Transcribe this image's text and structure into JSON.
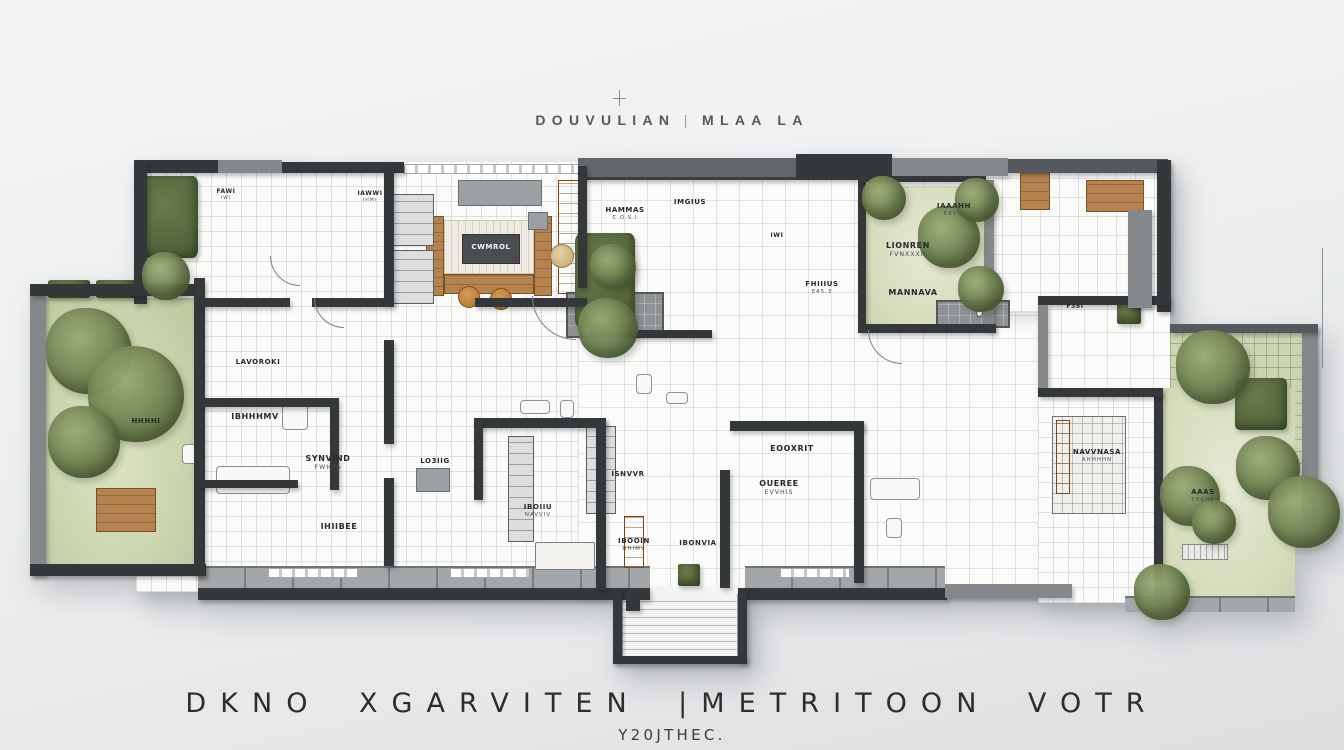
{
  "title": {
    "left": "DOUVULIAN",
    "separator": "|",
    "right": "MLAA LA"
  },
  "caption": {
    "line1": "DKNO XGARVITEN |METRITOON VOTR",
    "line2": "Y20JTHEC."
  },
  "colors": {
    "background": "#eceeef",
    "wall_dark": "#35383b",
    "wall_gray": "#85888b",
    "lawn_green": "#ccd6b6",
    "lawn_pale": "#dfe3cd",
    "tree_green": "#6d7e4e",
    "wood": "#b5834f",
    "cabinet_orange": "#bf7a33",
    "deck_gray": "#a4a7a9"
  },
  "plan": {
    "labels": [
      {
        "text": "FAWI",
        "sub": "IWI",
        "x": 196,
        "y": 40,
        "size": 6
      },
      {
        "text": "IAWWI",
        "sub": "IHMI",
        "x": 340,
        "y": 42,
        "size": 6
      },
      {
        "text": "HAMMAS",
        "sub": "C.O.S.I",
        "x": 595,
        "y": 58,
        "size": 7
      },
      {
        "text": "IMGIUS",
        "x": 660,
        "y": 50,
        "size": 7
      },
      {
        "text": "IWI",
        "x": 747,
        "y": 84,
        "size": 6
      },
      {
        "text": "LIONREN",
        "sub": "FVNXXXN",
        "x": 878,
        "y": 93,
        "size": 8
      },
      {
        "text": "MANNAVA",
        "x": 883,
        "y": 140,
        "size": 8
      },
      {
        "text": "IAAAHH",
        "sub": "EXVLI",
        "x": 924,
        "y": 54,
        "size": 7
      },
      {
        "text": "FHIIIUS",
        "sub": "E45.3",
        "x": 792,
        "y": 132,
        "size": 7
      },
      {
        "text": "F38I",
        "x": 1045,
        "y": 155,
        "size": 6
      },
      {
        "text": "CWMROL",
        "x": 461,
        "y": 95,
        "size": 7,
        "light": true
      },
      {
        "text": "LAVOROKI",
        "x": 228,
        "y": 210,
        "size": 7
      },
      {
        "text": "IBHHHMV",
        "x": 225,
        "y": 264,
        "size": 8
      },
      {
        "text": "SYNVIND",
        "sub": "FWHYA",
        "x": 298,
        "y": 306,
        "size": 8
      },
      {
        "text": "IHIIBEE",
        "x": 309,
        "y": 374,
        "size": 8
      },
      {
        "text": "LO3IIG",
        "x": 405,
        "y": 309,
        "size": 7
      },
      {
        "text": "ISNVVR",
        "x": 598,
        "y": 322,
        "size": 7
      },
      {
        "text": "IBOIIU",
        "sub": "NAVVIV",
        "x": 508,
        "y": 355,
        "size": 7
      },
      {
        "text": "IBOOIN",
        "sub": "HHIMV",
        "x": 604,
        "y": 389,
        "size": 7
      },
      {
        "text": "IBONVIA",
        "x": 668,
        "y": 391,
        "size": 7
      },
      {
        "text": "EOOXRIT",
        "x": 762,
        "y": 296,
        "size": 8
      },
      {
        "text": "OUEREE",
        "sub": "EVVHIS",
        "x": 749,
        "y": 331,
        "size": 8
      },
      {
        "text": "NAVVNASA",
        "sub": "AHHHHN",
        "x": 1067,
        "y": 300,
        "size": 7
      },
      {
        "text": "AAAS",
        "sub": "THKHE",
        "x": 1173,
        "y": 340,
        "size": 7
      },
      {
        "text": "HHHHI",
        "x": 116,
        "y": 269,
        "size": 7
      }
    ]
  }
}
